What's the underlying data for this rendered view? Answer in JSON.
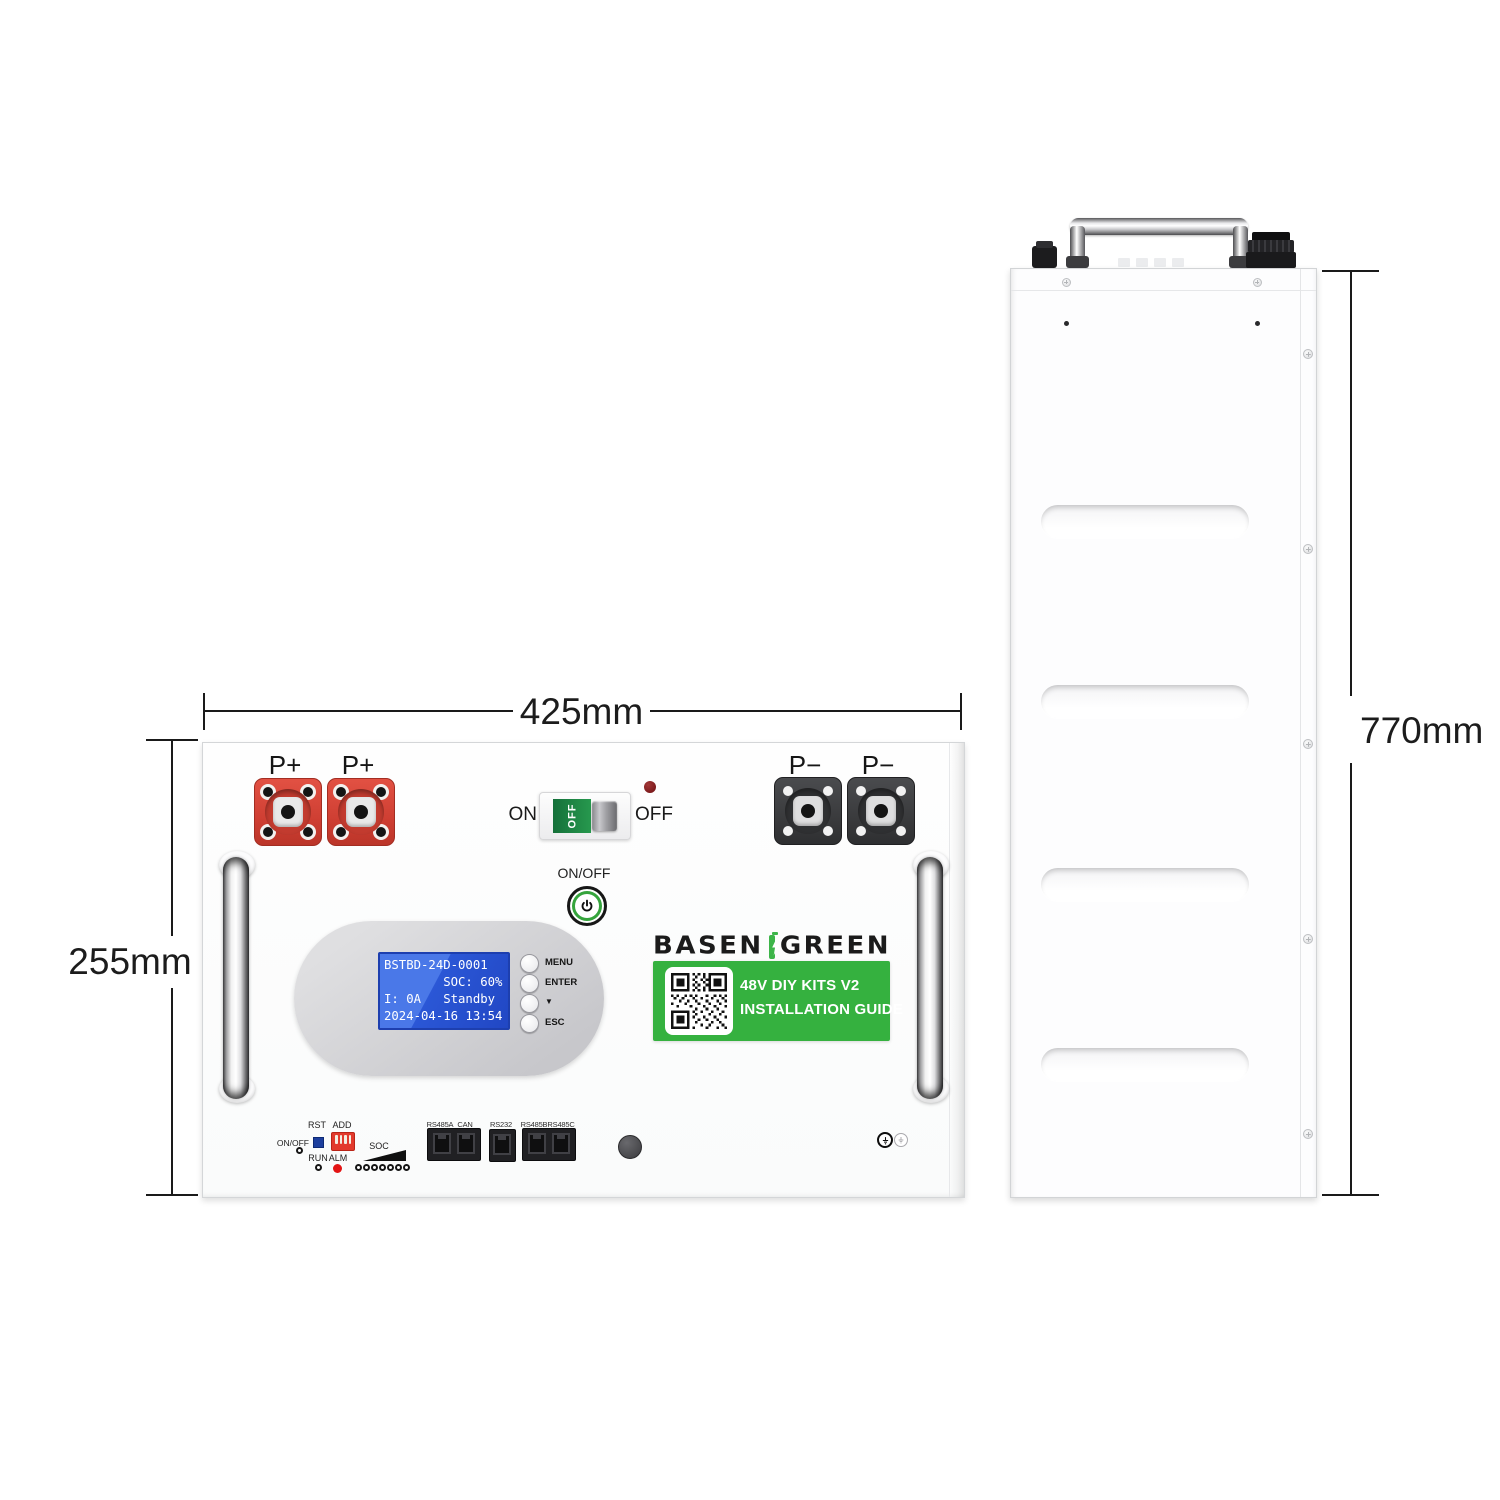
{
  "dimensions": {
    "front_width": "425mm",
    "front_height": "255mm",
    "side_height": "770mm"
  },
  "front_panel": {
    "positive_terminal_labels": [
      "P+",
      "P+"
    ],
    "negative_terminal_labels": [
      "P−",
      "P−"
    ],
    "breaker": {
      "on_label": "ON",
      "off_label": "OFF",
      "switch_text": "OFF",
      "state": "OFF"
    },
    "power_button": {
      "label": "ON/OFF"
    },
    "lcd": {
      "line1": "BSTBD-24D-0001",
      "line2": "        SOC: 60%",
      "line3": "I: 0A   Standby",
      "line4": "2024-04-16 13:54"
    },
    "menu_buttons": [
      "MENU",
      "ENTER",
      "▼",
      "ESC"
    ],
    "logo": {
      "left": "BASEN",
      "right": "GREEN"
    },
    "guide_label": {
      "line1": "48V DIY KITS V2",
      "line2": "INSTALLATION GUIDE"
    },
    "io": {
      "rst_label": "RST",
      "add_label": "ADD",
      "onoff_label": "ON/OFF",
      "run_label": "RUN",
      "alm_label": "ALM",
      "soc_label": "SOC",
      "ports": [
        "RS485A",
        "CAN",
        "RS232",
        "RS485B",
        "RS485C"
      ]
    }
  },
  "colors": {
    "label_green": "#35b13f",
    "battery_green": "#3db549",
    "terminal_red": "#d7473b",
    "terminal_black": "#3f4042",
    "lcd_blue": "#2e5fd9",
    "breaker_green": "#1e8c46",
    "alarm_red": "#e31414",
    "dimension_text": "#1c1c1c"
  }
}
